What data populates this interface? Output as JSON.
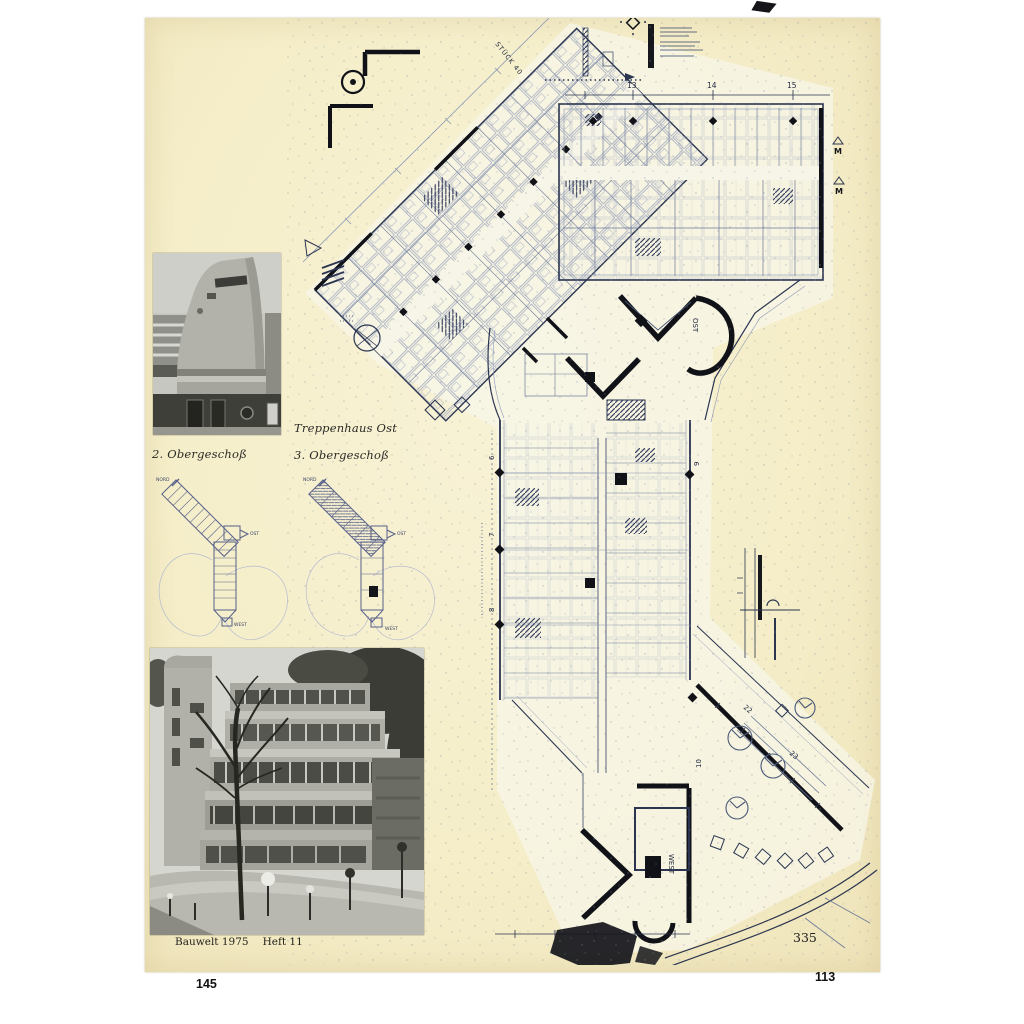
{
  "document": {
    "captions": {
      "stair_title": "Treppenhaus Ost",
      "photo_caption_left": "2. Obergeschoß",
      "plan_caption_right": "3. Obergeschoß"
    },
    "footer": {
      "journal": "Bauwelt 1975",
      "issue": "Heft 11",
      "page_number": "335"
    },
    "margin_numbers": {
      "bottom_left": "145",
      "bottom_right": "113"
    }
  },
  "main_plan": {
    "diagonal_label": "STÜCK 40",
    "grid_numbers_top": [
      "13",
      "14",
      "15"
    ],
    "grid_numbers_wing_left": [
      "6",
      "7",
      "8"
    ],
    "grid_numbers_wing_right": [
      "9",
      "10"
    ],
    "site_numbers": [
      "22",
      "23"
    ],
    "stair_label_east": "OST",
    "stair_label_west": "WEST",
    "section_marker": "M"
  },
  "mini_plans": {
    "left": {
      "north_label": "NORD",
      "east_label": "OST",
      "west_label": "WEST"
    },
    "right": {
      "north_label": "NORD",
      "east_label": "OST",
      "west_label": "WEST"
    }
  },
  "colors": {
    "paper": "#f5eec9",
    "plan_ink": "#2b3550",
    "heavy_ink": "#101218",
    "background": "#ffffff"
  }
}
